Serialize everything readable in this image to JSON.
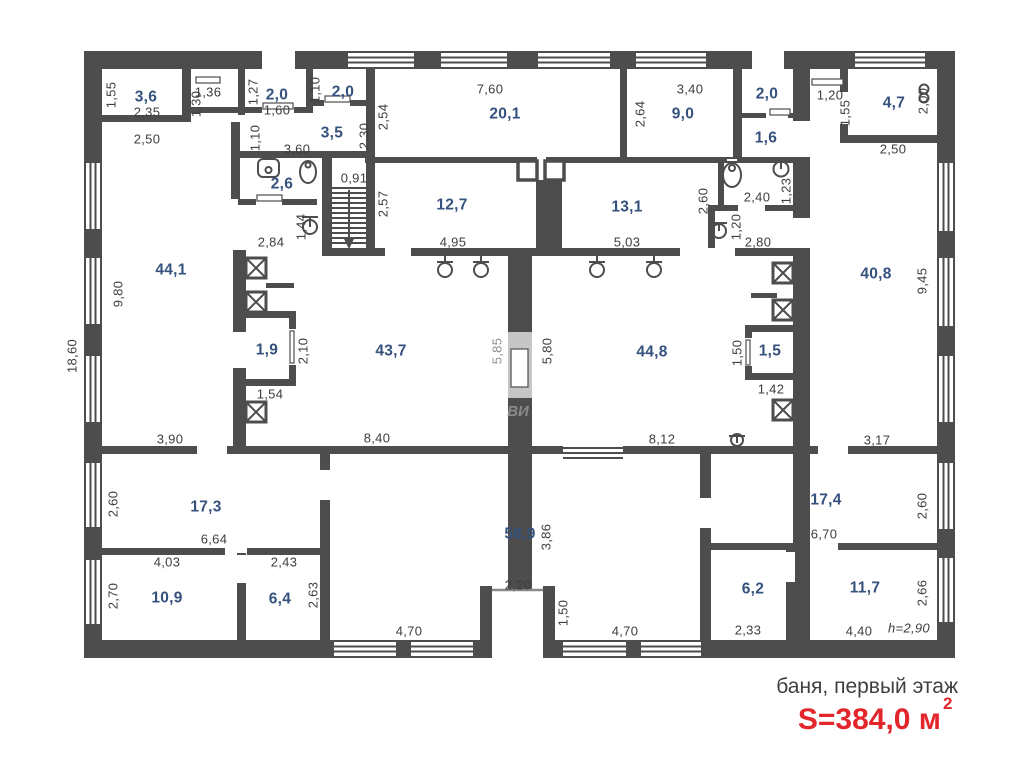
{
  "title": {
    "caption": "баня, первый этаж",
    "area_label": "S=384,0 м",
    "area_sup": "2"
  },
  "watermark": {
    "text": "ВИ"
  },
  "colors": {
    "wall": "#4d4d4d",
    "room_label": "#35517d",
    "dim_text": "#3e3e3e",
    "accent_red": "#e2262b"
  },
  "areas": {
    "r3_6": "3,6",
    "r2_0a": "2,0",
    "r2_0b": "2,0",
    "r3_5": "3,5",
    "r2_6": "2,6",
    "r20_1": "20,1",
    "r9_0": "9,0",
    "r12_7": "12,7",
    "r13_1": "13,1",
    "r2_0c": "2,0",
    "r1_6": "1,6",
    "r4_7": "4,7",
    "r44_1": "44,1",
    "r1_9": "1,9",
    "r43_7": "43,7",
    "r44_8": "44,8",
    "r1_5": "1,5",
    "r40_8": "40,8",
    "r17_3": "17,3",
    "r10_9": "10,9",
    "r6_4": "6,4",
    "r58_9": "58,9",
    "r17_4": "17,4",
    "r6_2": "6,2",
    "r11_7": "11,7"
  },
  "dims": [
    "1,55",
    "2,35",
    "2,50",
    "1,36",
    "1,30",
    "1,27",
    "1,60",
    "1,10",
    "1,10",
    "3,60",
    "2,30",
    "0,91",
    "2,57",
    "1,44",
    "2,84",
    "7,60",
    "2,54",
    "4,95",
    "3,40",
    "2,64",
    "5,03",
    "2,60",
    "2,40",
    "1,23",
    "1,20",
    "2,80",
    "1,20",
    "1,55",
    "2,00",
    "2,50",
    "9,80",
    "18,60",
    "3,90",
    "2,10",
    "1,54",
    "8,40",
    "5,85",
    "5,80",
    "8,12",
    "1,50",
    "1,42",
    "9,45",
    "3,17",
    "2,60",
    "6,64",
    "4,03",
    "2,70",
    "2,43",
    "2,63",
    "3,86",
    "2,20",
    "1,50",
    "4,70",
    "4,70",
    "2,60",
    "6,70",
    "2,33",
    "4,40",
    "2,66",
    "h=2,90"
  ]
}
